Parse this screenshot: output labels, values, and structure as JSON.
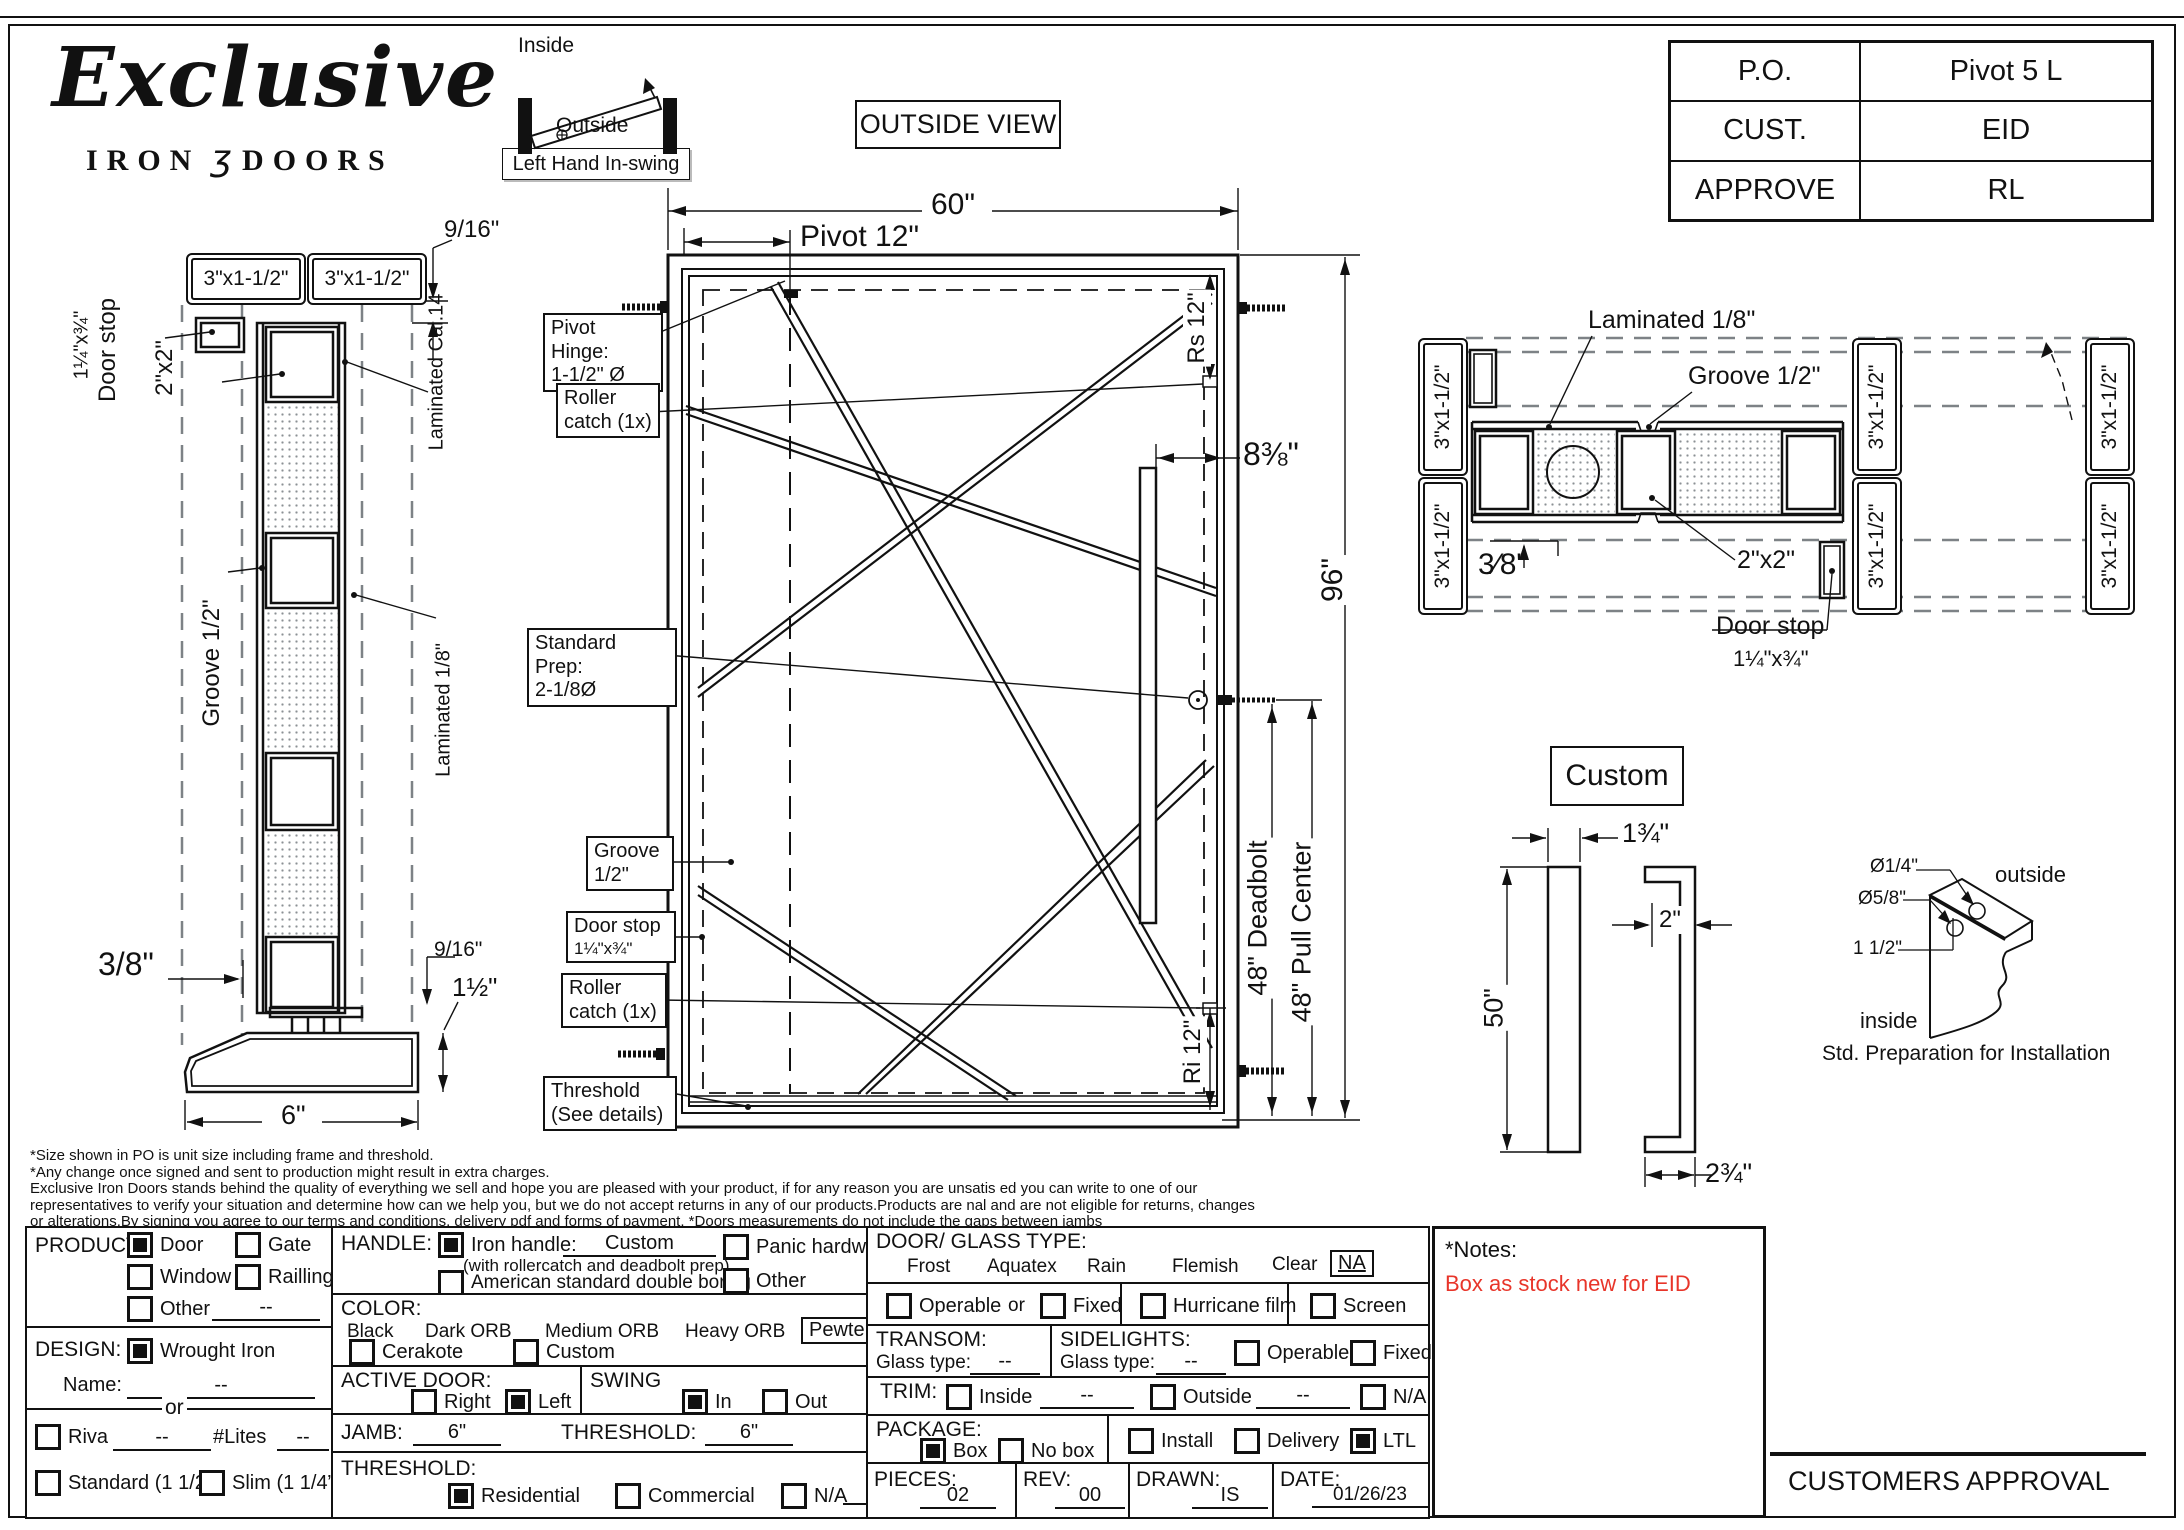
{
  "header": {
    "brand_script": "Exclusive",
    "brand_word1": "IRON",
    "brand_glyph": "ʒ",
    "brand_word2": "DOORS",
    "view_title": "OUTSIDE VIEW",
    "swing": {
      "inside": "Inside",
      "outside": "Outside",
      "tag": "Left Hand In-swing"
    },
    "po_table": {
      "rows": [
        {
          "label": "P.O.",
          "value": "Pivot 5 L"
        },
        {
          "label": "CUST.",
          "value": "EID"
        },
        {
          "label": "APPROVE",
          "value": "RL"
        }
      ]
    }
  },
  "side_view": {
    "jamb_box_left": "3\"x1-1/2\"",
    "jamb_box_right": "3\"x1-1/2\"",
    "dim_top": "9/16\"",
    "door_stop_1": "Door stop",
    "door_stop_2": "1¼\"x¾\"",
    "tube": "2\"x2\"",
    "groove": "Groove 1/2\"",
    "laminated_cal": "Laminated Cal.14",
    "laminated_eighth": "Laminated 1/8\"",
    "dim_gap": "3/8\"",
    "dim_916": "9/16\"",
    "dim_threshold_h": "1½\"",
    "dim_width": "6\""
  },
  "outside_view": {
    "dim_width": "60\"",
    "dim_pivot": "Pivot 12\"",
    "dim_rs": "Rs 12\"",
    "dim_handle": "8⅜\"",
    "dim_height": "96\"",
    "dim_deadbolt": "48\" Deadbolt",
    "dim_pull": "48\" Pull Center",
    "dim_ri": "Ri 12\"",
    "callouts": {
      "pivot_hinge_1": "Pivot Hinge:",
      "pivot_hinge_2": "1-1/2\" Ø",
      "roller_top_1": "Roller",
      "roller_top_2": "catch (1x)",
      "prep_1": "Standard Prep:",
      "prep_2": "2-1/8Ø",
      "groove_1": "Groove",
      "groove_2": "1/2\"",
      "door_stop_1": "Door stop",
      "door_stop_2": "1¼\"x¾\"",
      "roller_bot_1": "Roller",
      "roller_bot_2": "catch (1x)",
      "threshold_1": "Threshold",
      "threshold_2": "(See details)"
    }
  },
  "plan_view": {
    "jamb_box": "3\"x1-1/2\"",
    "laminated": "Laminated 1/8\"",
    "groove": "Groove 1/2\"",
    "tube": "2\"x2\"",
    "door_stop_1": "Door stop",
    "door_stop_2": "1¼\"x¾\"",
    "dim_gap": "3⁄8\""
  },
  "handle_detail": {
    "title": "Custom",
    "dim_width": "1¾\"",
    "dim_depth": "2\"",
    "dim_length": "50\"",
    "dim_total": "2¾\""
  },
  "prep_detail": {
    "dia_small": "Ø1/4\"",
    "dia_large": "Ø5/8\"",
    "offset": "1 1/2\"",
    "outside": "outside",
    "inside": "inside",
    "caption": "Std. Preparation for Installation"
  },
  "disclaimer": {
    "lines": [
      "*Size shown in PO is unit size including frame and threshold.",
      "*Any change once signed and sent to production might result in extra charges.",
      "Exclusive Iron Doors stands behind the quality of everything we sell and hope you are pleased with your product, if for any reason you are unsatis   ed you can write to one of our",
      "representatives to verify your situation and determine how can we help you, but we do not accept returns in any of our products.Products are    nal and are not eligible for returns, changes",
      "or alterations.By signing you agree to our terms and conditions, delivery pdf and forms of payment. *Doors measurements do not include the gaps between jambs"
    ]
  },
  "form": {
    "product": {
      "title": "PRODUCT:",
      "opts": [
        {
          "label": "Door",
          "on": true
        },
        {
          "label": "Gate",
          "on": false
        },
        {
          "label": "Window",
          "on": false
        },
        {
          "label": "Railling",
          "on": false
        },
        {
          "label": "Other",
          "on": false
        }
      ],
      "other_value": "--"
    },
    "design": {
      "title": "DESIGN:",
      "wrought": {
        "label": "Wrought Iron",
        "on": true
      },
      "name_label": "Name:",
      "name_value": "--",
      "or_label": "or",
      "riva": {
        "label": "Riva",
        "on": false
      },
      "riva_value": "--",
      "lites_label": "#Lites",
      "lites_value": "--",
      "standard": {
        "label": "Standard (1 1/2”)",
        "on": false
      },
      "slim": {
        "label": "Slim (1 1/4”)",
        "on": false
      }
    },
    "handle": {
      "title": "HANDLE:",
      "iron": {
        "label": "Iron handle:",
        "on": true
      },
      "iron_value": "Custom",
      "iron_note": "(with rollercatch and deadbolt prep)",
      "american": {
        "label": "American standard double boring",
        "on": false
      },
      "panic": {
        "label": "Panic hardware",
        "on": false
      },
      "other": {
        "label": "Other",
        "on": false
      }
    },
    "color": {
      "title": "COLOR:",
      "options": [
        "Black",
        "Dark ORB",
        "Medium ORB",
        "Heavy ORB",
        "Pewter",
        "Antique gold"
      ],
      "selected": "Pewter",
      "cerakote": {
        "label": "Cerakote",
        "on": false
      },
      "custom": {
        "label": "Custom",
        "on": false
      }
    },
    "active_door": {
      "title": "ACTIVE DOOR:",
      "right": {
        "label": "Right",
        "on": false
      },
      "left": {
        "label": "Left",
        "on": true
      }
    },
    "swing": {
      "title": "SWING",
      "in": {
        "label": "In",
        "on": true
      },
      "out": {
        "label": "Out",
        "on": false
      }
    },
    "jamb": {
      "label": "JAMB:",
      "value": "6\""
    },
    "threshold_size": {
      "label": "THRESHOLD:",
      "value": "6\""
    },
    "threshold": {
      "title": "THRESHOLD:",
      "residential": {
        "label": "Residential",
        "on": true
      },
      "commercial": {
        "label": "Commercial",
        "on": false
      },
      "na": {
        "label": "N/A",
        "on": false
      }
    },
    "glass": {
      "title": "DOOR/ GLASS TYPE:",
      "options": [
        "Frost",
        "Aquatex",
        "Rain",
        "Flemish",
        "Clear",
        "NA"
      ],
      "selected": "NA",
      "operable": {
        "label": "Operable",
        "on": false
      },
      "or_label": "or",
      "fixed": {
        "label": "Fixed",
        "on": false
      },
      "hurricane": {
        "label": "Hurricane film",
        "on": false
      },
      "screen": {
        "label": "Screen",
        "on": false
      }
    },
    "transom": {
      "title": "TRANSOM:",
      "glass_label": "Glass type:",
      "value": "--"
    },
    "sidelights": {
      "title": "SIDELIGHTS:",
      "glass_label": "Glass type:",
      "value": "--",
      "operable": {
        "label": "Operable",
        "on": false
      },
      "fixed": {
        "label": "Fixed",
        "on": false
      }
    },
    "trim": {
      "title": "TRIM:",
      "inside": {
        "label": "Inside",
        "on": false
      },
      "inside_value": "--",
      "outside": {
        "label": "Outside",
        "on": false
      },
      "outside_value": "--",
      "na": {
        "label": "N/A",
        "on": false
      }
    },
    "package": {
      "title": "PACKAGE:",
      "box": {
        "label": "Box",
        "on": true
      },
      "nobox": {
        "label": "No box",
        "on": false
      },
      "install": {
        "label": "Install",
        "on": false
      },
      "delivery": {
        "label": "Delivery",
        "on": false
      },
      "ltl": {
        "label": "LTL",
        "on": true
      }
    },
    "meta": {
      "pieces_label": "PIECES:",
      "pieces": "02",
      "rev_label": "REV:",
      "rev": "00",
      "drawn_label": "DRAWN:",
      "drawn": "IS",
      "date_label": "DATE:",
      "date": "01/26/23"
    }
  },
  "notes": {
    "title": "*Notes:",
    "body": "Box as stock new for EID",
    "color": "#e8352a"
  },
  "approval_label": "CUSTOMERS APPROVAL"
}
